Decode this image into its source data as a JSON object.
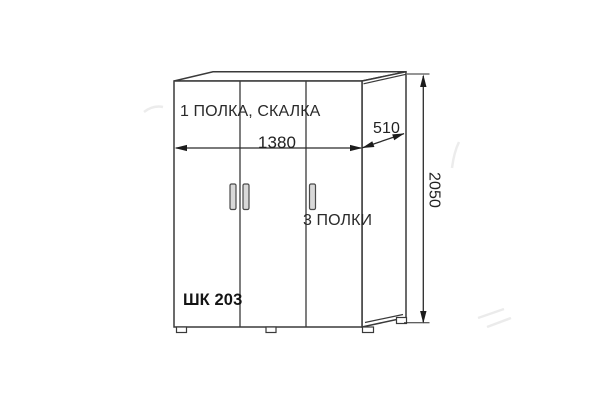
{
  "diagram_type": "furniture-technical-drawing",
  "labels": {
    "top_compartment": "1 ПОЛКА, СКАЛКА",
    "right_compartment": "3 ПОЛКИ",
    "model": "ШК 203"
  },
  "dimensions": {
    "width_mm": "1380",
    "depth_mm": "510",
    "height_mm": "2050"
  },
  "structure": {
    "doors": 3,
    "handles": 3,
    "feet": 4
  },
  "colors": {
    "line": "#3a3a3a",
    "dimension": "#2b2b2b",
    "text": "#2a2a2a",
    "handle_fill": "#d9d9d9",
    "handle_stroke": "#4a4a4a",
    "background": "#ffffff",
    "watermark": "#d5d5d5"
  }
}
